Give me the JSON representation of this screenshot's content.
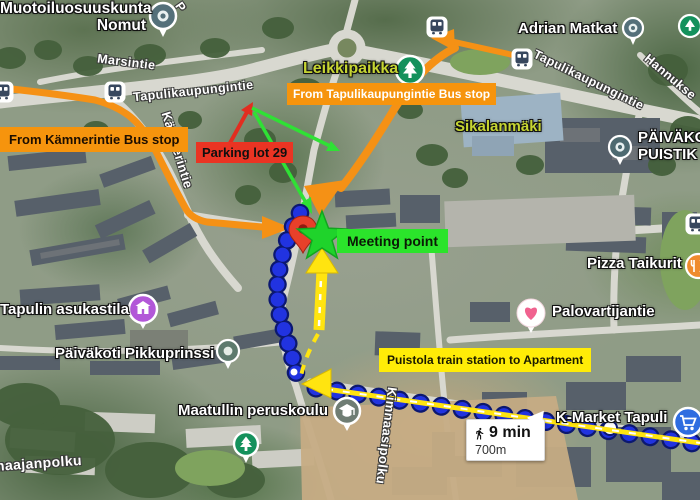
{
  "map": {
    "type": "annotated-satellite-map",
    "labels": {
      "muotoiluosuuskunta_line1": "Muotoiluosuuskunta",
      "muotoiluosuuskunta_line2": "Nomut",
      "adrian_matkat": "Adrian Matkat",
      "leikkipaikka": "Leikkipaikka",
      "sikalanmaki": "Sikalanmäki",
      "paivakoti_puistikko_line1": "PÄIVÄKO",
      "paivakoti_puistikko_line2": "PUISTIK",
      "pizza_taikurit": "Pizza Taikurit",
      "palovartijantie": "Palovartijantie",
      "tapulin_asukastila": "Tapulin asukastila",
      "paivakoti_pikkuprinssi": "Päiväkoti Pikkuprinssi",
      "maatullin_peruskoulu": "Maatullin peruskoulu",
      "k_market_tapuli": "K-Market Tapuli"
    },
    "streets": {
      "marsintie": "Marsintie",
      "tapulikaupungintie_west": "Tapulikaupungintie",
      "tapulikaupungintie_east": "Tapulikaupungintie",
      "hannuksentie_partial": "Hannukse",
      "kamnerintie": "Kämnerintie",
      "kimnaasipolku": "Kimnaasipolku",
      "maajanpolku_partial": "maajanpolku",
      "partial_p": "P"
    },
    "callouts": {
      "from_tapulikaupungintie_bus_stop": "From Tapulikaupungintie Bus stop",
      "from_kamnerintie_bus_stop": "From Kämnerintie Bus stop",
      "parking_lot": "Parking lot 29",
      "meeting_point": "Meeting point",
      "walk_route": "Puistola train station to Apartment"
    },
    "walk_info": {
      "duration": "9 min",
      "distance": "700m"
    },
    "colors": {
      "callout_orange": "#f6940d",
      "callout_red": "#ea3423",
      "callout_green": "#2be42b",
      "callout_yellow": "#ffec07",
      "route_dot_blue": "#2133e0",
      "street_label_green": "#c6d532",
      "meeting_star_green": "#1fd32b"
    },
    "icons": [
      "bus-stop-icon",
      "tree-park-icon",
      "school-pin-icon",
      "heart-favorite-icon",
      "community-center-icon",
      "restaurant-icon",
      "shopping-cart-icon",
      "meeting-pin-icon",
      "meeting-star-icon",
      "walking-person-icon",
      "place-pin-icon"
    ]
  }
}
